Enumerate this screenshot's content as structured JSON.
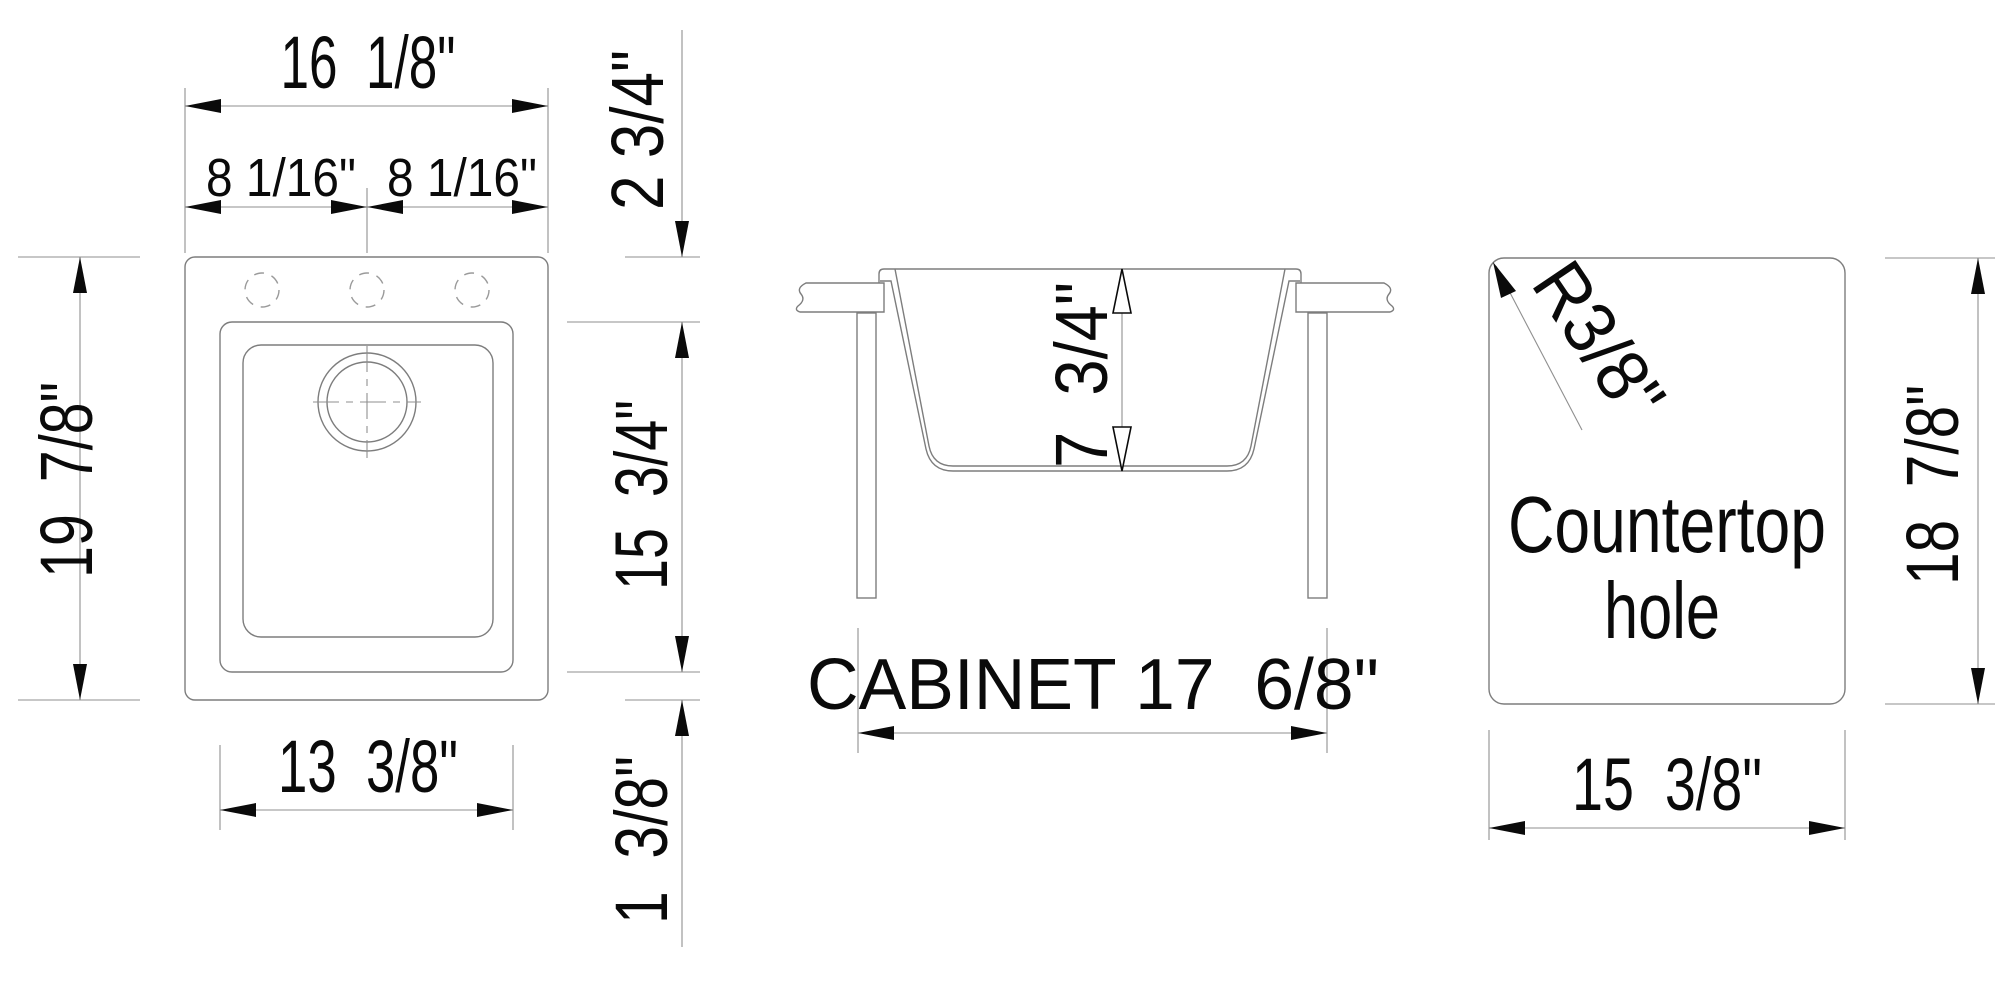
{
  "colors": {
    "line": "#7d7d7d",
    "dim_line": "#8f8f8f",
    "dash_line": "#9a9a9a",
    "ink": "#0a0a0a",
    "background": "#ffffff"
  },
  "top_view": {
    "overall_width": "16  1/8\"",
    "half_width_left": "8 1/16\"",
    "half_width_right": "8 1/16\"",
    "overall_depth": "19  7/8\"",
    "bowl_width": "13  3/8\"",
    "rim_offset_top": "2 3/4\"",
    "bowl_length": "15  3/4\"",
    "rim_offset_bottom": "1  3/8\""
  },
  "section_view": {
    "bowl_depth": "7  3/4\"",
    "cabinet_size": "CABINET 17  6/8\""
  },
  "hole_view": {
    "corner_radius": "R3/8\"",
    "label_line1": "Countertop",
    "label_line2": "hole",
    "hole_height": "18  7/8\"",
    "hole_width": "15  3/8\""
  }
}
